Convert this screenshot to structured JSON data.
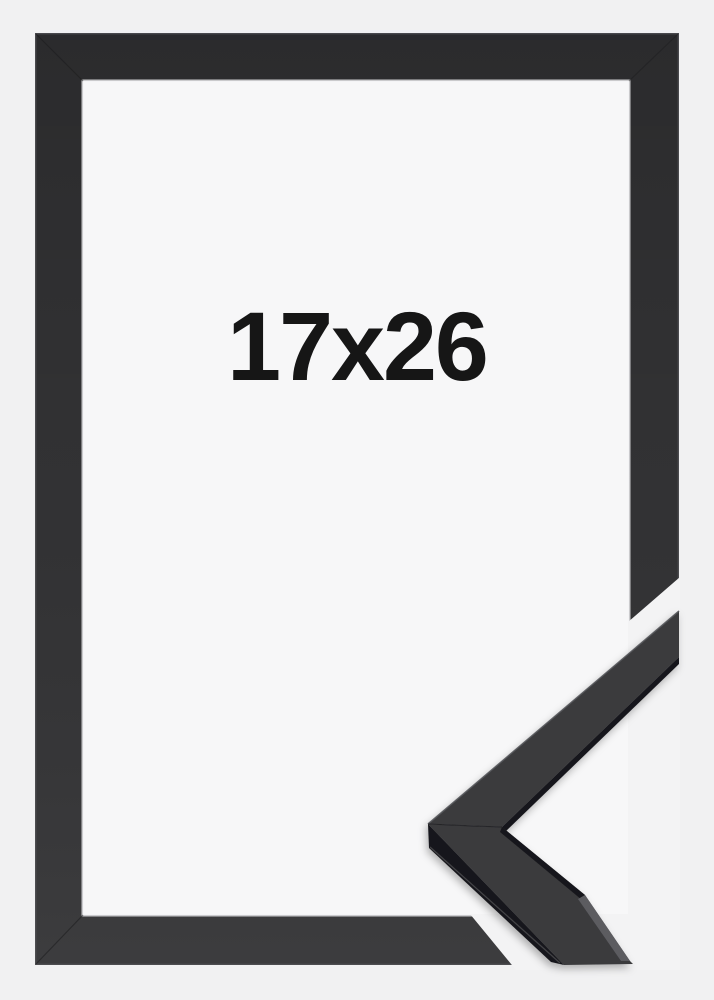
{
  "image": {
    "size_label": "17x26",
    "colors": {
      "background": "#f1f1f2",
      "cutout_gap": "#f3f3f4",
      "interior": "#f7f7f8",
      "frame": "#323234",
      "frame_face": "#3a3a3d",
      "frame_side": "#19191b",
      "end_cut_face": "#5c5c60",
      "label_text": "#161616"
    }
  }
}
